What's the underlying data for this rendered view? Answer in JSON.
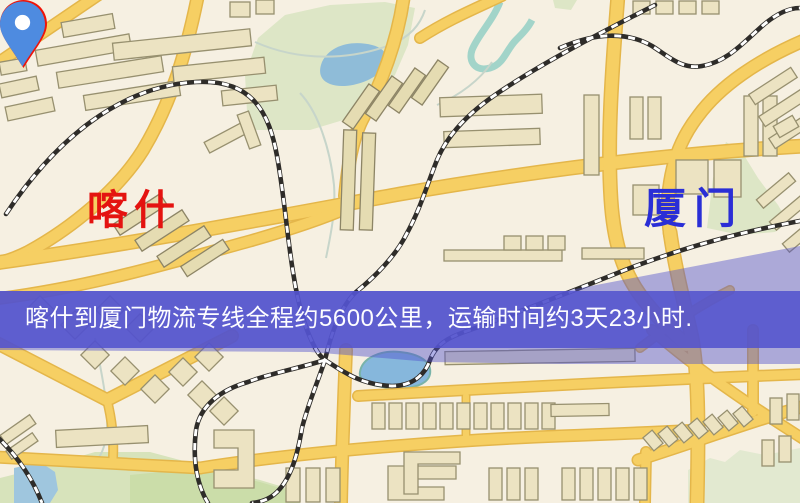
{
  "map": {
    "origin": {
      "label": "喀什",
      "marker": "red-map-pin"
    },
    "destination": {
      "label": "厦门",
      "marker": "blue-map-pin"
    },
    "banner": {
      "text": "喀什到厦门物流专线全程约5600公里，运输时间约3天23小时.",
      "distance": "约5600公里",
      "duration": "约3天23小时"
    }
  },
  "colors": {
    "banner_bg": "#5353cd",
    "banner_text": "#fdfdff",
    "origin_pin": "#ee1409",
    "origin_label": "#e41310",
    "destination_pin": "#4e8be0",
    "destination_label": "#2a2ed6",
    "road_yellow": "#f6cf63",
    "map_background": "#f6f0e2"
  }
}
